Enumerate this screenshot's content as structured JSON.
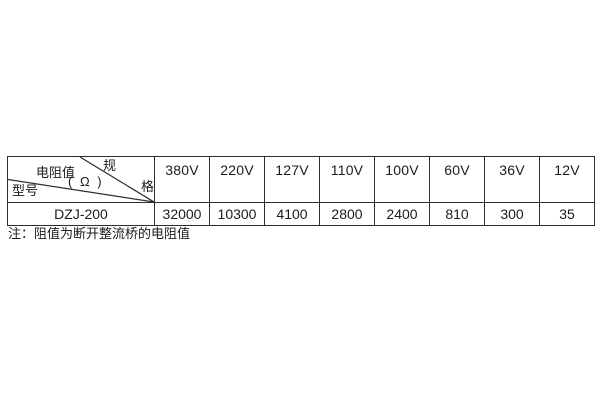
{
  "table": {
    "corner": {
      "spec_char_top": "规",
      "spec_char_bottom": "格",
      "resistance_label": "电阻值",
      "resistance_unit": "( Ω )",
      "model_label": "型号"
    },
    "columns": [
      "380V",
      "220V",
      "127V",
      "110V",
      "100V",
      "60V",
      "36V",
      "12V"
    ],
    "rows": [
      {
        "model": "DZJ-200",
        "values": [
          "32000",
          "10300",
          "4100",
          "2800",
          "2400",
          "810",
          "300",
          "35"
        ]
      }
    ]
  },
  "note": "注：阻值为断开整流桥的电阻值",
  "colors": {
    "background": "#ffffff",
    "border": "#2e2e2e",
    "text": "#1c1c1c"
  }
}
